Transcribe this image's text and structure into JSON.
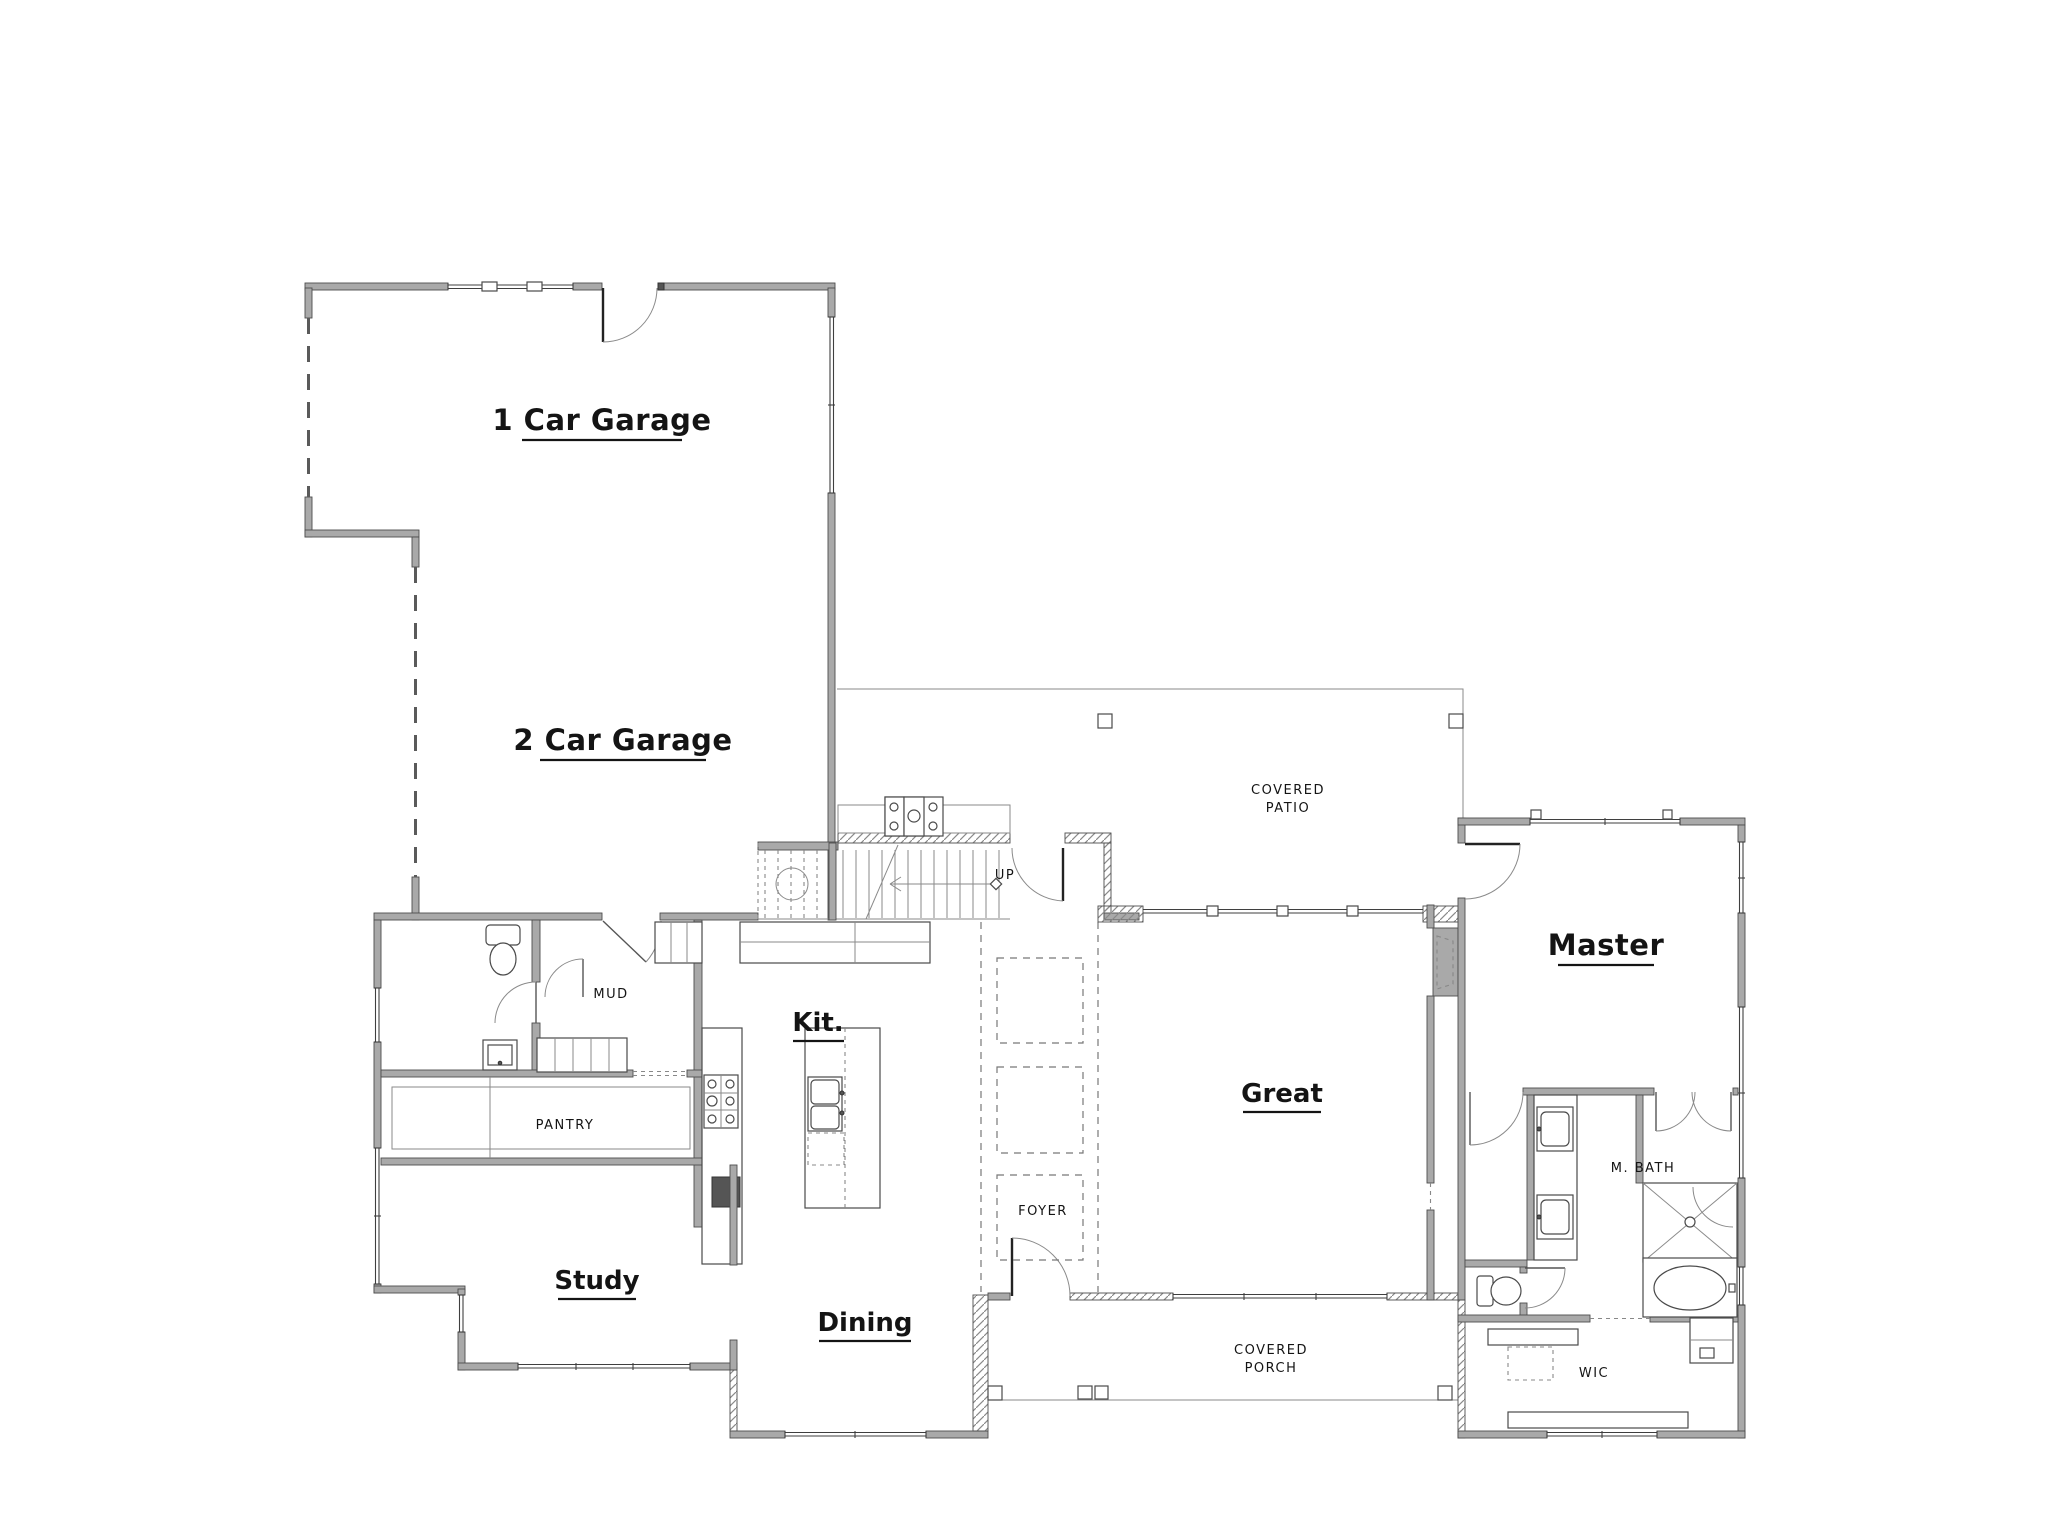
{
  "drawing": {
    "type": "residential first-floor plan",
    "background": "#ffffff"
  },
  "colors": {
    "wall_fill": "#a9a9a9",
    "wall_edge": "#4d4d4d",
    "hatch_line": "#8a8a8a",
    "thin_line": "#4a4a4a",
    "dashed_line": "#777777",
    "text": "#141414",
    "background": "#ffffff"
  },
  "labels": {
    "garage1": "1 Car Garage",
    "garage2": "2 Car Garage",
    "master": "Master",
    "great": "Great",
    "kitchen": "Kit.",
    "study": "Study",
    "dining": "Dining",
    "mud": "MUD",
    "pantry": "PANTRY",
    "foyer": "FOYER",
    "up": "UP",
    "covered_patio_1": "COVERED",
    "covered_patio_2": "PATIO",
    "covered_porch_1": "COVERED",
    "covered_porch_2": "PORCH",
    "master_bath": "M. BATH",
    "wic": "WIC"
  }
}
